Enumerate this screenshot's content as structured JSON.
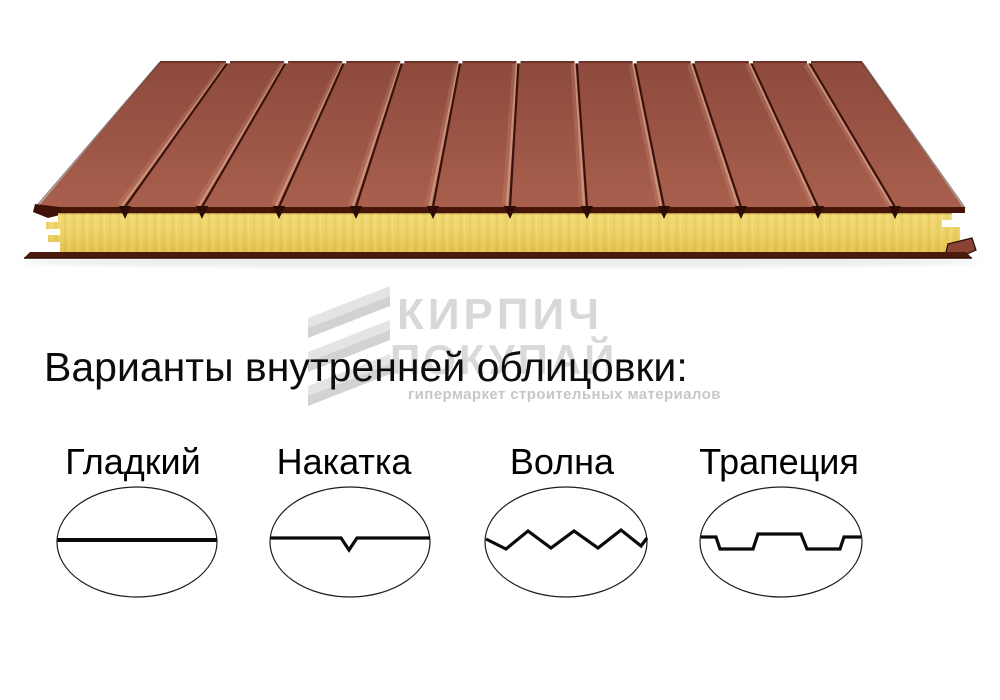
{
  "headline": {
    "text": "Варианты внутренней облицовки:"
  },
  "watermark": {
    "brand": "КИРПИЧ",
    "line2": "ПОКУПАЙ",
    "tagline": "гипермаркет строительных материалов",
    "color": "#d8d8d8"
  },
  "panel": {
    "groove_count": 11,
    "face_color": "#a05a4a",
    "face_color_dark": "#8d4a3d",
    "groove_color": "#3a120b",
    "groove_highlight": "#cf977e",
    "metal_edge_color": "#471408",
    "core_color": "#ecd165",
    "core_color_light": "#f1da72",
    "core_color_dark": "#e2c24f",
    "bottom_sheet_color": "#4c1b0d"
  },
  "options": [
    {
      "label": "Гладкий",
      "profile": "smooth"
    },
    {
      "label": "Накатка",
      "profile": "notch"
    },
    {
      "label": "Волна",
      "profile": "wave"
    },
    {
      "label": "Трапеция",
      "profile": "trapezoid"
    }
  ]
}
